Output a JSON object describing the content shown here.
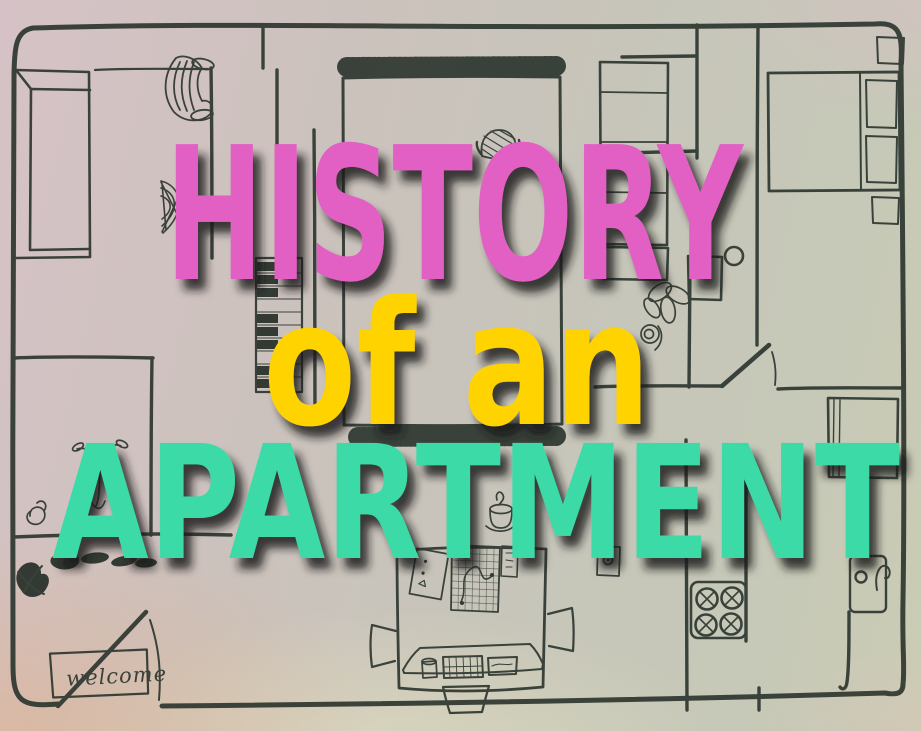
{
  "title": {
    "line1": {
      "text": "HISTORY",
      "color": "#e25fc3"
    },
    "line2": {
      "text": "of an",
      "color": "#ffd303"
    },
    "line3": {
      "text": "APARTMENT",
      "color": "#3adaa7"
    },
    "shadow_color": "#17161d"
  },
  "floor_plan": {
    "doormat_text": "welcome",
    "ink_color": "#313a33",
    "objects": [
      "sofa",
      "console-table",
      "armchair",
      "wicker-chair",
      "rug",
      "basket",
      "piano",
      "wardrobe",
      "bed",
      "nightstands",
      "flower-doodle",
      "bathroom-vanity",
      "dining-table",
      "chairs",
      "notebook",
      "map-sheet",
      "phone",
      "wall-outlet",
      "candle",
      "cup",
      "laptop-board",
      "stove",
      "kitchen-sink",
      "shoes",
      "hook-doodle",
      "doormat",
      "door-swing",
      "plant-doodle"
    ]
  },
  "background": {
    "base_left": "#d6c2c6",
    "base_mid": "#c7c5ba",
    "base_right": "#cbccb4",
    "corner_warm": "#e8aa76",
    "corner_pink": "#e2bacd",
    "bottom_glow": "#f0eebe"
  }
}
